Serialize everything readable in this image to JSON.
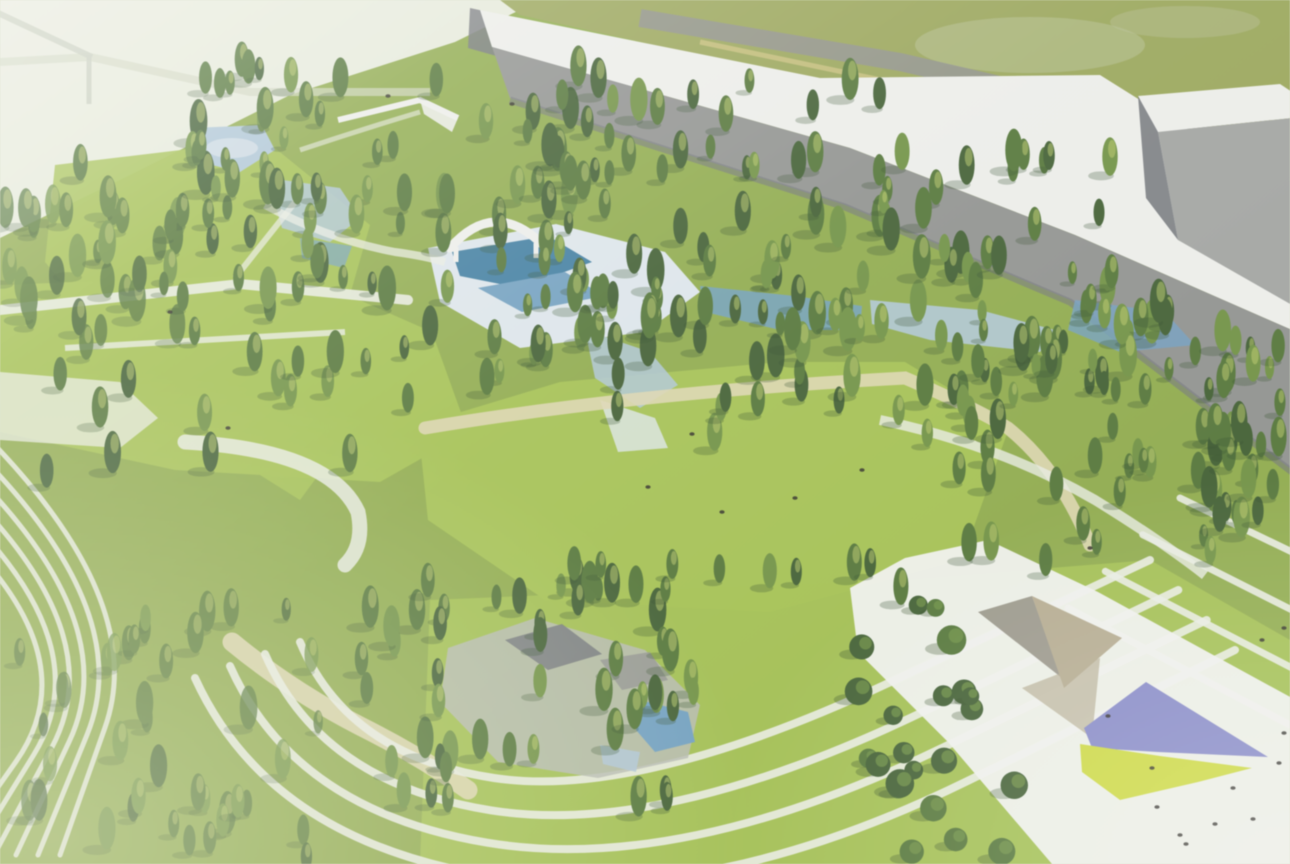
{
  "scene": {
    "description": "Aerial architectural rendering of a landscaped park: dense conifer forest and bright lawns, a central pool complex with a white arched canopy, terraced slopes with parallel white walking paths, long gray warehouse buildings with white roofs along the top edge, an olive field and perimeter road behind them, and a white plaza at lower right with a faceted pavilion, a purple canopy and a chartreuse lawn panel dotted with people.",
    "features": {
      "north_field": "olive field beyond buildings",
      "perimeter_road": "gray road along field",
      "warehouse": "long gray warehouse with white roof",
      "office_box": "gray box building at far right",
      "crane": "thin pole at top-left corner",
      "nw_pond": "small pond on northwest lawn",
      "pavilion": "green-roofed pavilion with white trim",
      "pool_complex": "blue pools with white deck and arch canopy",
      "stream": "blue water patches threading east through trees",
      "central_meadow": "large open lawn at center",
      "terraces": "nested white terrace paths on slopes",
      "plaza": "white plaza band at lower right",
      "purple_canopy": "purple kite-shaped canopy",
      "yellow_panel": "chartreuse triangular lawn panel",
      "people": "small dark figure dots on plaza and meadow"
    }
  },
  "palette": {
    "sky_pale": "#e7ebdb",
    "sky_edge": "#cfd6bd",
    "field_olive": "#9aa657",
    "field_light": "#b7c193",
    "road_gray": "#8f918a",
    "road_tan": "#c9c07b",
    "roof_white": "#edeeea",
    "building_gray": "#90928f",
    "building_gray_dark": "#72757a",
    "building_box_gray": "#a2a4a1",
    "grass_bright": "#a4c14e",
    "grass_mid": "#8fab49",
    "grass_olive": "#7f9649",
    "stone_gray": "#b6bab0",
    "tree_dark": "#3f5e30",
    "tree_mid": "#527536",
    "tree_light": "#6e9140",
    "tree_highlight": "#c0cd67",
    "shadow_green": "#2f4a26",
    "path_white": "#e9ece2",
    "path_cream": "#ddd6ae",
    "deck_white": "#dde6eb",
    "water_light": "#aec6d6",
    "water_mid": "#6f9fc0",
    "water_deep": "#3e7da1",
    "plaza_white": "#eff0ec",
    "facet_gray": "#9b988b",
    "facet_tan": "#b5ab8e",
    "canopy_purple": "#8689c8",
    "canopy_yellow": "#ccd93c",
    "people_dark": "#2e2b26",
    "haze_white": "#f2f4ea"
  }
}
